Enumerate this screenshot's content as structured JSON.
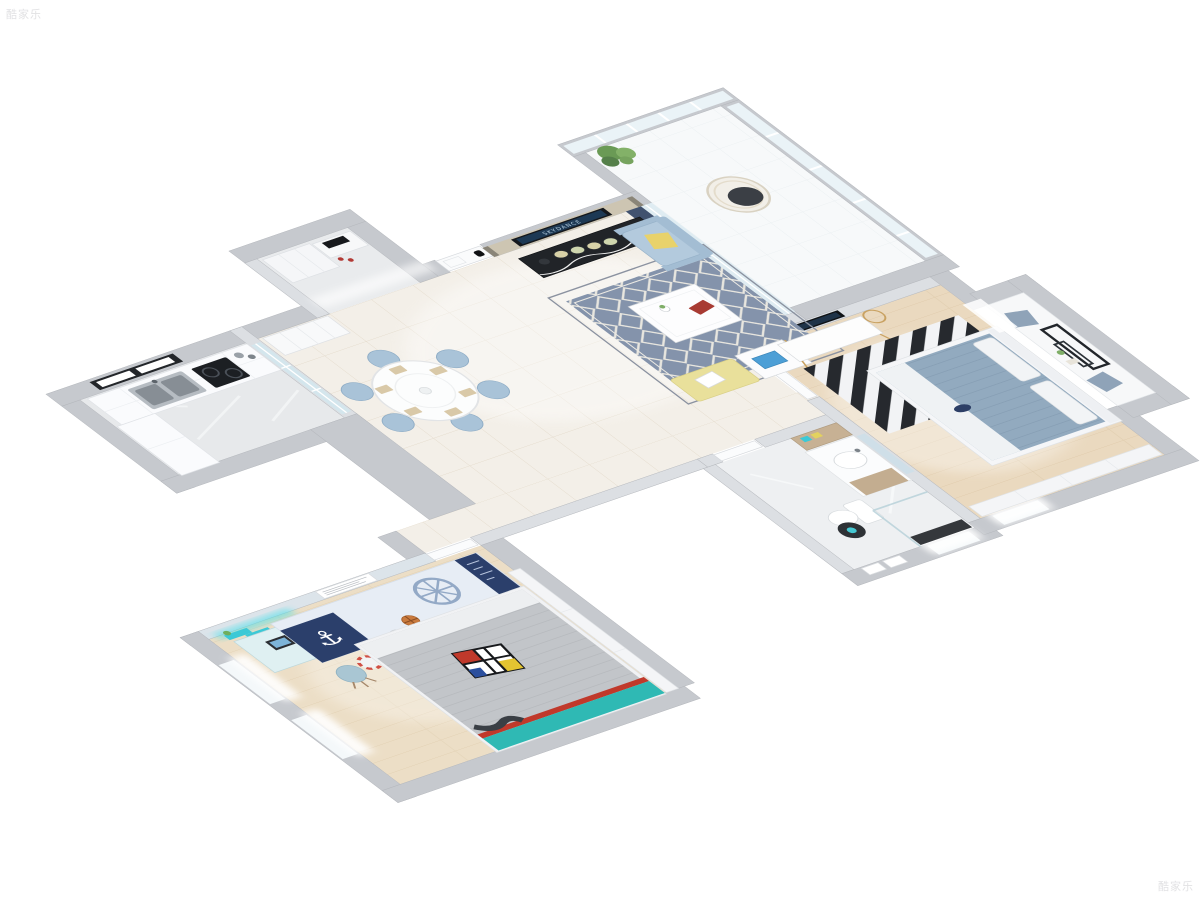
{
  "meta": {
    "scene_type": "3d-isometric-apartment-floorplan-render",
    "background": "#ffffff",
    "watermark": {
      "text": "酷家乐"
    }
  },
  "palette": {
    "wall_exterior": "#c6c9ce",
    "wall_interior": "#dcdfe3",
    "floor_tile_cream": "#f3efe8",
    "floor_marble_gray": "#e7e9eb",
    "floor_wood_bedroom": "#ead9bf",
    "floor_wood_kids": "#ecdec6",
    "accent_navy": "#2b3f6b",
    "accent_light_blue": "#a9c3d8",
    "accent_cyan": "#3cc9d6",
    "accent_yellow": "#e8d26b",
    "rug_living": "#8493ab",
    "tv_cabinet_black": "#212428"
  },
  "living_room": {
    "name": "living room",
    "tv_brand": "SKYDANCE",
    "furniture": [
      "tv wall",
      "tv cabinet",
      "decor plates",
      "trellis rug",
      "coffee table",
      "flower vase",
      "red book",
      "armchair",
      "yellow pillow",
      "yellow bench",
      "white tray table",
      "blue magazine"
    ]
  },
  "balcony": {
    "name": "balcony",
    "furniture": [
      "floor-to-ceiling windows",
      "hanging rattan chair",
      "wall plant",
      "navy curtains",
      "sheer curtain"
    ]
  },
  "master_bedroom": {
    "name": "master bedroom",
    "furniture": [
      "wall tv",
      "desk",
      "round mirror",
      "navy pouf",
      "chevron rug",
      "double bed",
      "bay window seat",
      "gray pillows",
      "black picture frames",
      "wardrobe"
    ]
  },
  "bathroom": {
    "name": "bathroom",
    "furniture": [
      "wood vanity",
      "mirror",
      "storage cabinet",
      "toilet",
      "black round mat",
      "glass shower",
      "towels",
      "window"
    ]
  },
  "kitchen": {
    "name": "kitchen",
    "furniture": [
      "window",
      "double sink",
      "gas stove",
      "white counters",
      "glass sliding door"
    ]
  },
  "dining_room": {
    "name": "dining room",
    "furniture": [
      "round table",
      "place settings",
      "blue chairs",
      "pantry cabinet"
    ]
  },
  "entry": {
    "name": "entry hall",
    "furniture": [
      "entry door",
      "intercom",
      "built-in cabinet",
      "shoe cabinet",
      "black tray"
    ]
  },
  "kids_room": {
    "name": "kids bedroom",
    "anchor_glyph": "⚓",
    "furniture": [
      "desk with laptop",
      "cyan zigzag shelves",
      "blue chair",
      "framed text art",
      "nautical rug",
      "ship wheel motif",
      "life ring",
      "soccer ball",
      "basketball",
      "bed with gray duvet",
      "mondrian pillow",
      "teal bed frame",
      "sliding wardrobe",
      "windows"
    ]
  }
}
